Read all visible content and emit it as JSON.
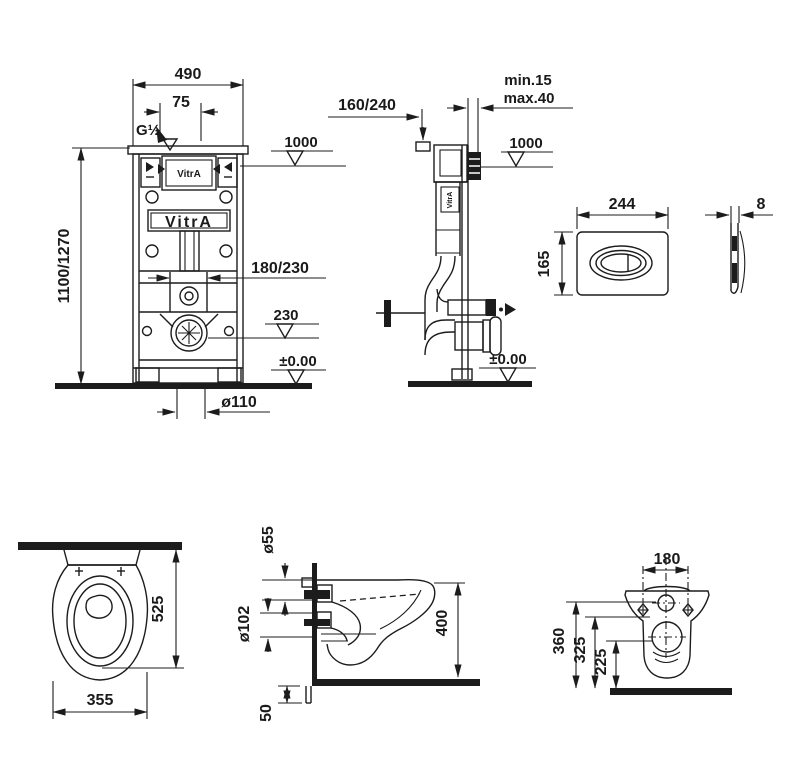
{
  "drawing": {
    "brand": "VitrA",
    "frame_front": {
      "dim_width": "490",
      "dim_inlet_offset": "75",
      "inlet_thread": "G½",
      "dim_height": "1100/1270",
      "datum_button": "1000",
      "dim_rails": "180/230",
      "datum_outlet": "230",
      "datum_floor": "±0.00",
      "dim_drain": "ø110",
      "logo_top": "VitrA",
      "logo_panel": "VitrA"
    },
    "frame_side": {
      "dim_depth": "160/240",
      "wall_min": "min.15",
      "wall_max": "max.40",
      "datum_button": "1000",
      "datum_floor": "±0.00",
      "logo": "VitrA"
    },
    "plate_front": {
      "dim_width": "244",
      "dim_height": "165"
    },
    "plate_side": {
      "dim_thickness": "8"
    },
    "wc_top": {
      "dim_depth": "525",
      "dim_width": "355"
    },
    "wc_side": {
      "dim_inlet": "ø55",
      "dim_outlet": "ø102",
      "dim_height": "400",
      "dim_bottom": "50"
    },
    "wc_back": {
      "dim_holes": "180",
      "dim_h1": "360",
      "dim_h2": "325",
      "dim_h3": "225"
    }
  }
}
